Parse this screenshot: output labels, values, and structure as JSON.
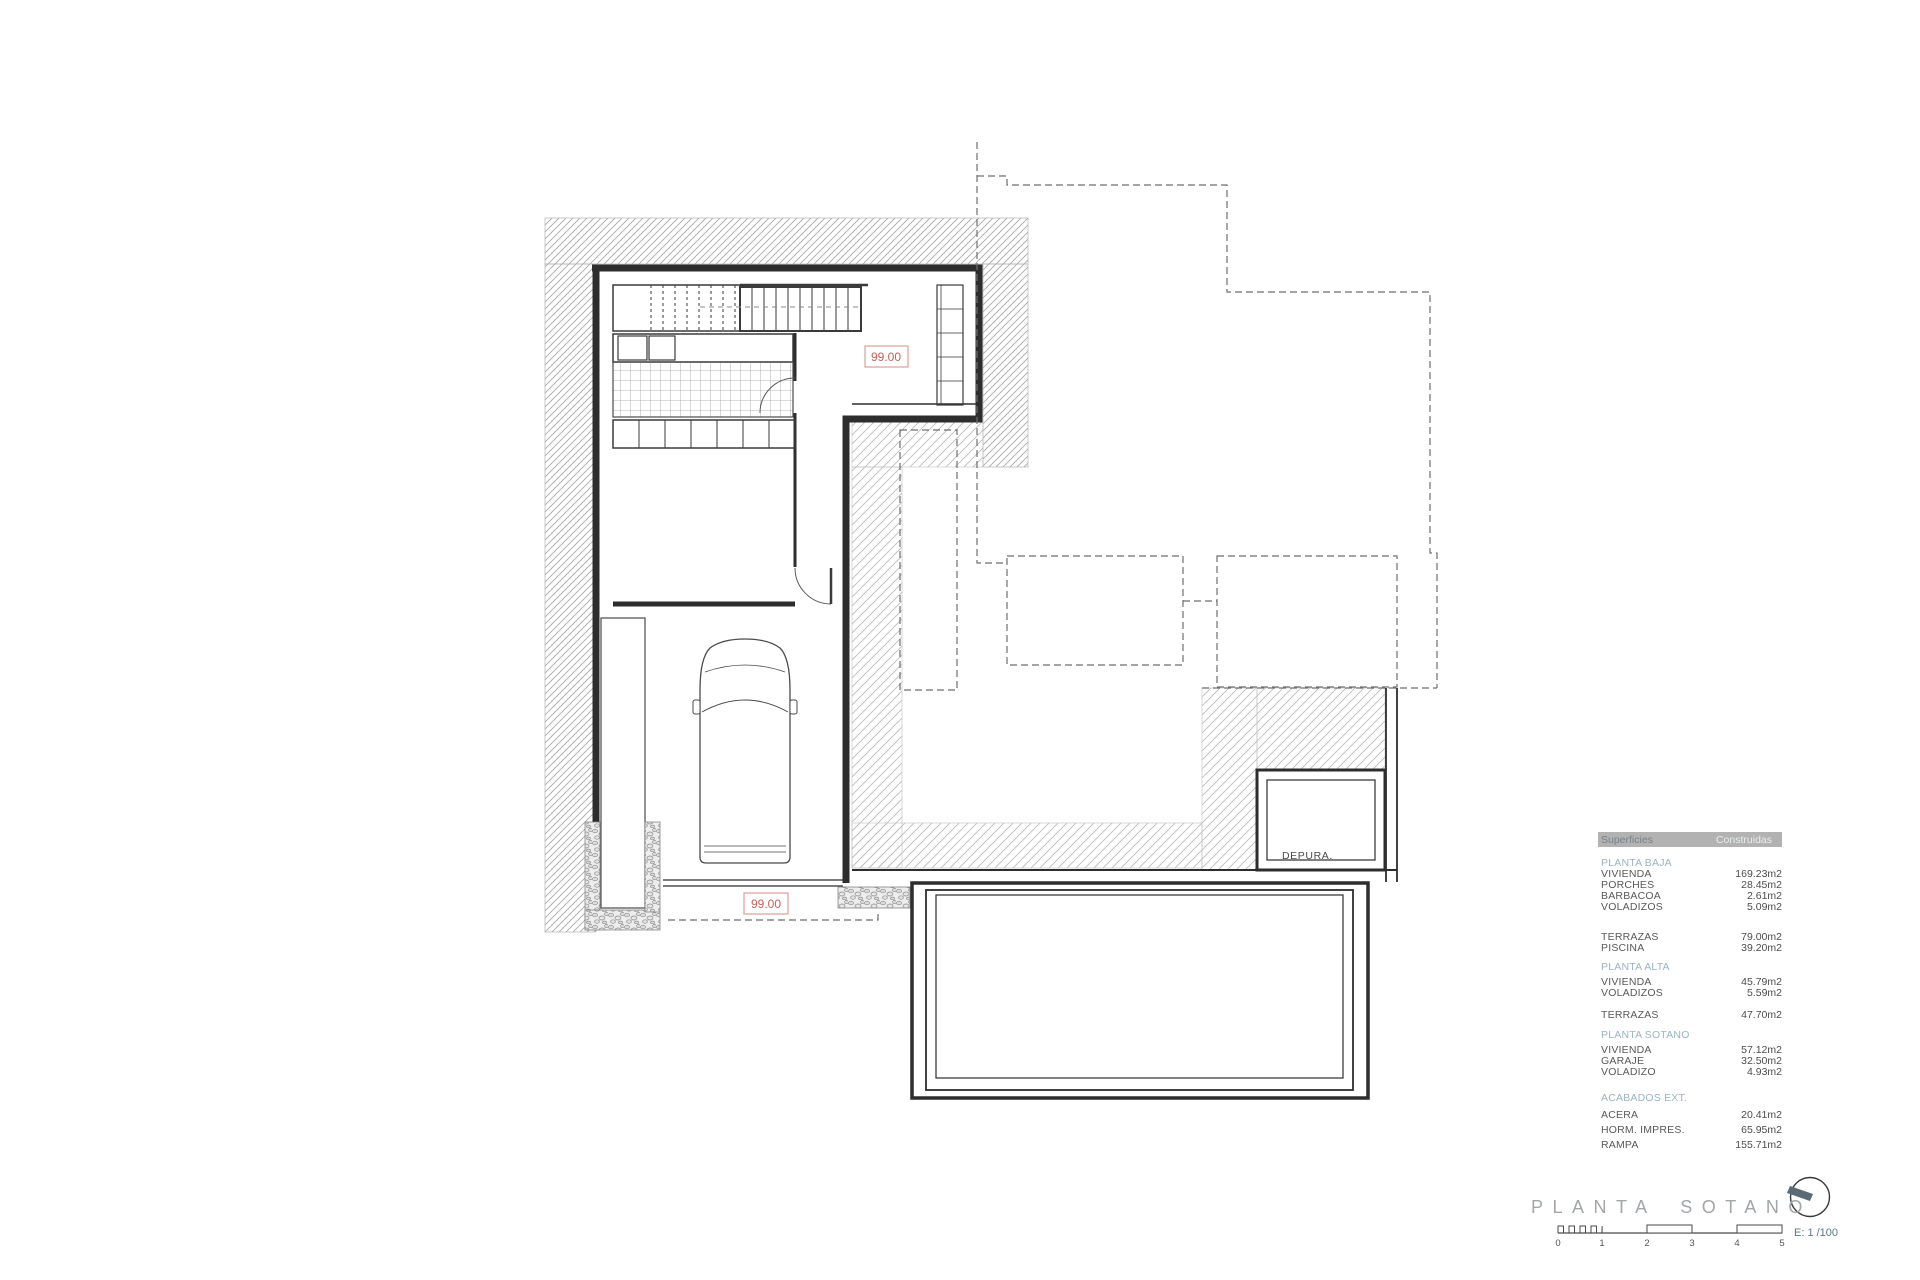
{
  "sheet": {
    "title": "PLANTA SOTANO",
    "scale": {
      "label": "E: 1 /100",
      "ticks": [
        "0",
        "1",
        "2",
        "3",
        "4",
        "5"
      ]
    }
  },
  "plan": {
    "labels": {
      "level_upper": "99.00",
      "level_lower": "99.00",
      "depura": "DEPURA."
    }
  },
  "table": {
    "header": {
      "col1": "Superficies",
      "col2": "Construidas"
    },
    "rows": [
      {
        "type": "section",
        "label": "PLANTA BAJA",
        "value": "",
        "gap": 11
      },
      {
        "type": "row",
        "label": "VIVIENDA",
        "value": "169.23m2",
        "gap": 0
      },
      {
        "type": "row",
        "label": "PORCHES",
        "value": "28.45m2",
        "gap": 0
      },
      {
        "type": "row",
        "label": "BARBACOA",
        "value": "2.61m2",
        "gap": 0
      },
      {
        "type": "row",
        "label": "VOLADIZOS",
        "value": "5.09m2",
        "gap": 0
      },
      {
        "type": "row",
        "label": "TERRAZAS",
        "value": "79.00m2",
        "gap": 19
      },
      {
        "type": "row",
        "label": "PISCINA",
        "value": "39.20m2",
        "gap": 0
      },
      {
        "type": "section",
        "label": "PLANTA ALTA",
        "value": "",
        "gap": 8
      },
      {
        "type": "row",
        "label": "VIVIENDA",
        "value": "45.79m2",
        "gap": 4
      },
      {
        "type": "row",
        "label": "VOLADIZOS",
        "value": "5.59m2",
        "gap": 0
      },
      {
        "type": "row",
        "label": "TERRAZAS",
        "value": "47.70m2",
        "gap": 11
      },
      {
        "type": "section",
        "label": "PLANTA SOTANO",
        "value": "",
        "gap": 9
      },
      {
        "type": "row",
        "label": "VIVIENDA",
        "value": "57.12m2",
        "gap": 4
      },
      {
        "type": "row",
        "label": "GARAJE",
        "value": "32.50m2",
        "gap": 0
      },
      {
        "type": "row",
        "label": "VOLADIZO",
        "value": "4.93m2",
        "gap": 0
      },
      {
        "type": "section",
        "label": "ACABADOS EXT.",
        "value": "",
        "gap": 15
      },
      {
        "type": "row",
        "label": "ACERA",
        "value": "20.41m2",
        "gap": 6
      },
      {
        "type": "row",
        "label": "HORM. IMPRES.",
        "value": "65.95m2",
        "gap": 4
      },
      {
        "type": "row",
        "label": "RAMPA",
        "value": "155.71m2",
        "gap": 4
      }
    ]
  },
  "colors": {
    "wall": "#2d2d2d",
    "hatch_dark": "#a8a8a8",
    "hatch_light": "#bdbdbd",
    "dashed_line": "#6e6e6e",
    "red_label_text": "#c2625c",
    "red_label_border": "#daa09a",
    "table_header_bg": "#b2b2b2",
    "table_section_text": "#9bb3c1",
    "title_text": "#a2a6a8",
    "scale_text": "#567888",
    "compass_needle": "#5b6b76"
  }
}
